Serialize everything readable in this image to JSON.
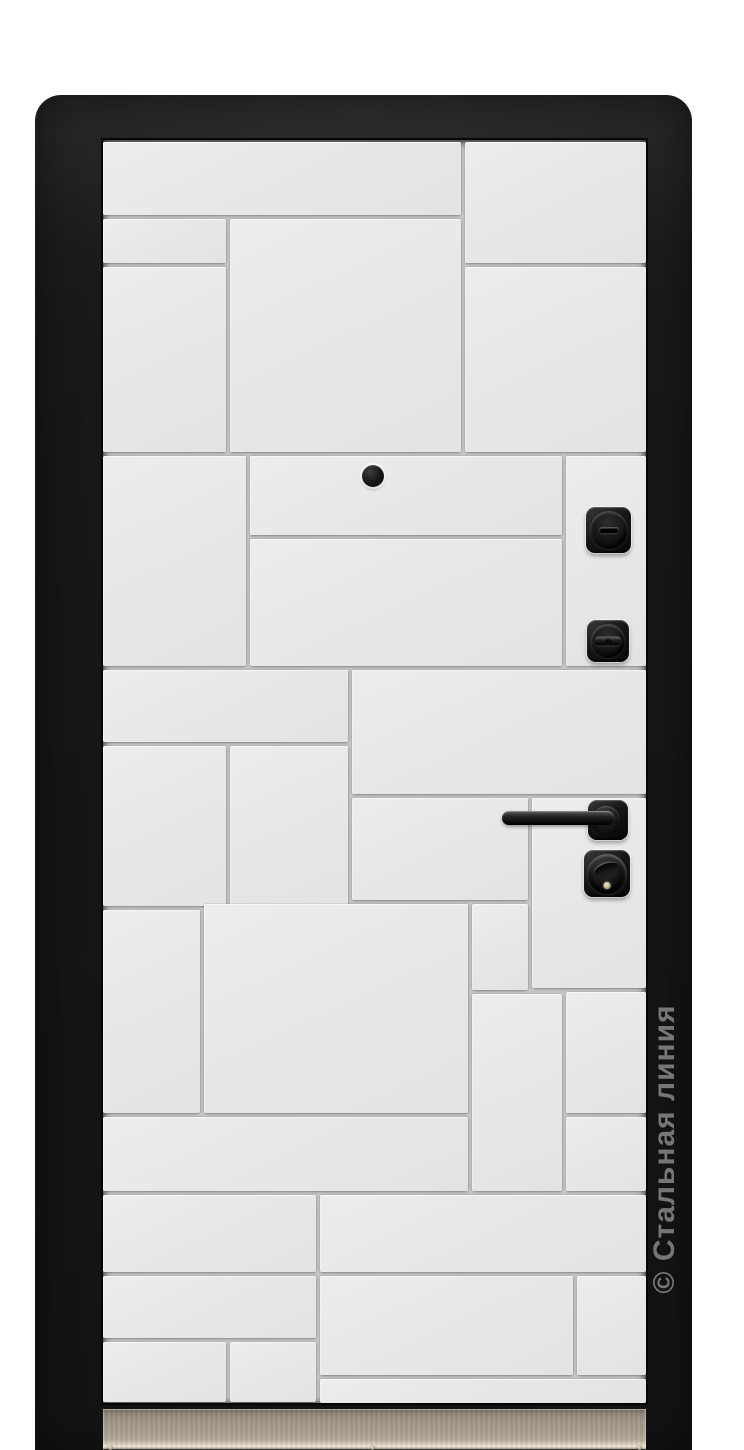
{
  "meta": {
    "description": "Product photo of a steel entrance door, interior side, white geometric quadro-pattern panel in a black slab frame",
    "background_color": "#ffffff"
  },
  "watermark": {
    "text": "© Стальная линия",
    "color": "#8c8c8c"
  },
  "door": {
    "slab": {
      "x": 35,
      "y": 95,
      "w": 657,
      "h": 1355,
      "color": "#171717"
    },
    "panel_area": {
      "x": 103,
      "y": 140,
      "w": 543,
      "h": 1263,
      "face_color": "#e7e8e8",
      "groove_color": "#c5c6c6"
    },
    "pattern_panels": [
      [
        103,
        142,
        358,
        73
      ],
      [
        465,
        142,
        181,
        121
      ],
      [
        103,
        219,
        123,
        44
      ],
      [
        230,
        219,
        231,
        233
      ],
      [
        103,
        267,
        123,
        185
      ],
      [
        465,
        267,
        181,
        185
      ],
      [
        103,
        456,
        143,
        210
      ],
      [
        250,
        456,
        312,
        79
      ],
      [
        250,
        539,
        312,
        127
      ],
      [
        566,
        456,
        80,
        210
      ],
      [
        103,
        670,
        245,
        72
      ],
      [
        352,
        670,
        294,
        124
      ],
      [
        103,
        746,
        123,
        160
      ],
      [
        230,
        746,
        118,
        160
      ],
      [
        352,
        798,
        176,
        102
      ],
      [
        532,
        798,
        114,
        190
      ],
      [
        472,
        904,
        56,
        86
      ],
      [
        103,
        910,
        97,
        203
      ],
      [
        204,
        904,
        264,
        209
      ],
      [
        472,
        994,
        90,
        197
      ],
      [
        566,
        992,
        80,
        121
      ],
      [
        566,
        1117,
        80,
        74
      ],
      [
        103,
        1117,
        365,
        74
      ],
      [
        103,
        1195,
        213,
        77
      ],
      [
        320,
        1195,
        326,
        77
      ],
      [
        103,
        1276,
        213,
        62
      ],
      [
        320,
        1276,
        253,
        99
      ],
      [
        577,
        1276,
        69,
        99
      ],
      [
        103,
        1342,
        123,
        60
      ],
      [
        230,
        1342,
        86,
        60
      ],
      [
        320,
        1379,
        326,
        24
      ]
    ],
    "hardware": {
      "peephole": {
        "x": 362,
        "y": 465,
        "w": 22,
        "h": 22
      },
      "thumbturn_upper": {
        "x": 586,
        "y": 507,
        "w": 45,
        "h": 46,
        "knob_d": 38
      },
      "thumbturn_lower": {
        "x": 587,
        "y": 620,
        "w": 42,
        "h": 42,
        "knob_d": 34
      },
      "handle_rose": {
        "x": 588,
        "y": 800,
        "w": 40,
        "h": 40
      },
      "handle_collar": {
        "x": 592,
        "y": 806,
        "w": 28,
        "h": 28
      },
      "handle_lever": {
        "x": 502,
        "y": 811,
        "w": 112,
        "h": 14
      },
      "cylinder_lock": {
        "x": 584,
        "y": 850,
        "w": 46,
        "h": 47,
        "ring_d": 40
      }
    },
    "kick_plate": {
      "x": 103,
      "y": 1409,
      "w": 543,
      "h": 41,
      "screw_y_offset": 36,
      "screws_x": [
        108,
        370,
        637
      ]
    }
  }
}
